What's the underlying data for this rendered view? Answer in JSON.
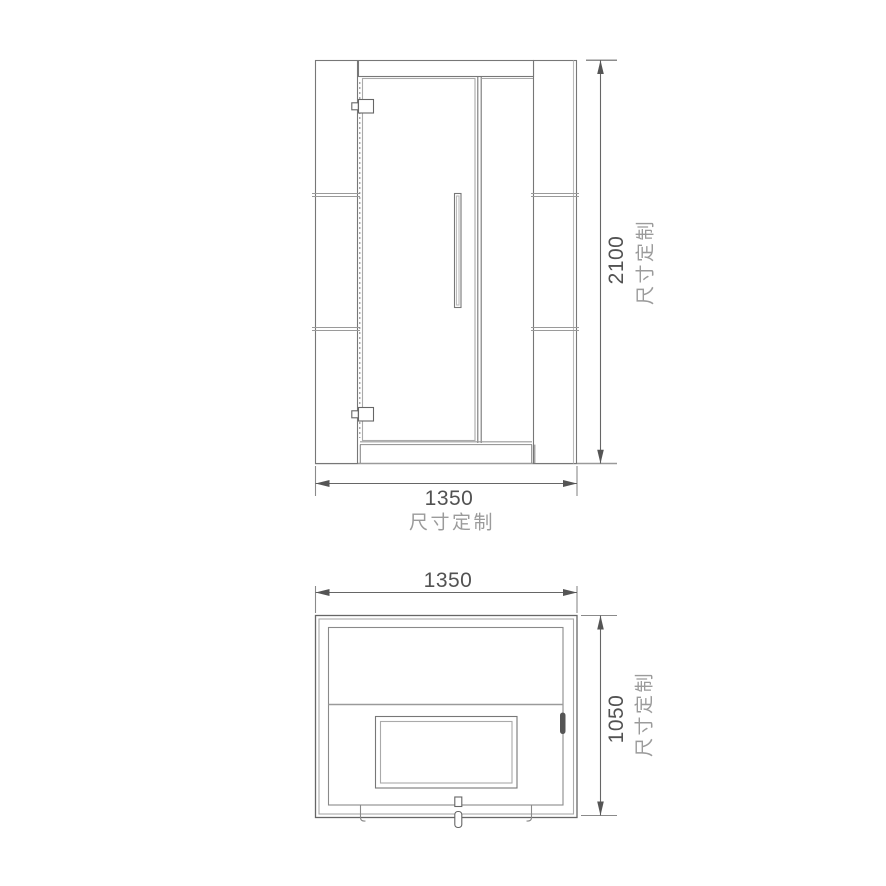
{
  "front_view": {
    "height_dim": {
      "value": "2100",
      "note": "尺寸定制"
    },
    "width_dim": {
      "value": "1350",
      "note": "尺寸定制"
    }
  },
  "plan_view": {
    "width_dim": {
      "value": "1350"
    },
    "depth_dim": {
      "value": "1050",
      "note": "尺寸定制"
    }
  },
  "colors": {
    "background": "#ffffff",
    "line_dark": "#555555",
    "line_main": "#777777",
    "line_light": "#aaaaaa",
    "line_gray": "#999999",
    "text_value": "#525252",
    "text_note": "#9b9b9b"
  }
}
